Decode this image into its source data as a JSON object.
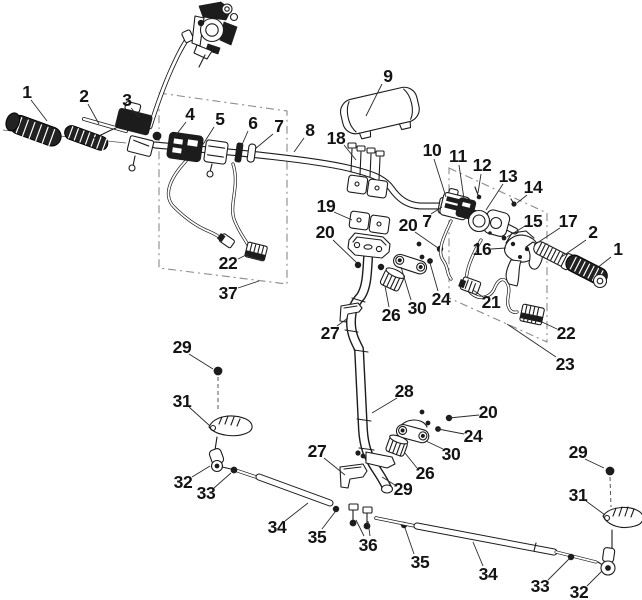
{
  "colors": {
    "ink": "#1c1c1c",
    "box_dash": "#8a8a8a",
    "leader": "#2b2b2b",
    "label": "#141414",
    "background": "#ffffff"
  },
  "callouts": [
    {
      "t": "1",
      "x": 27,
      "y": 92,
      "l": [
        31,
        100,
        47,
        121
      ]
    },
    {
      "t": "2",
      "x": 84,
      "y": 96,
      "l": [
        88,
        104,
        99,
        124
      ]
    },
    {
      "t": "3",
      "x": 127,
      "y": 100,
      "l": [
        131,
        108,
        139,
        117
      ]
    },
    {
      "t": "4",
      "x": 190,
      "y": 114,
      "l": [
        186,
        122,
        173,
        139
      ]
    },
    {
      "t": "5",
      "x": 220,
      "y": 119,
      "l": [
        214,
        127,
        202,
        146
      ]
    },
    {
      "t": "6",
      "x": 253,
      "y": 123,
      "l": [
        248,
        131,
        241,
        147
      ]
    },
    {
      "t": "7",
      "x": 279,
      "y": 126,
      "l": [
        273,
        134,
        255,
        149
      ]
    },
    {
      "t": "8",
      "x": 310,
      "y": 130,
      "l": [
        304,
        138,
        294,
        152
      ]
    },
    {
      "t": "9",
      "x": 388,
      "y": 76,
      "l": [
        382,
        84,
        366,
        116
      ]
    },
    {
      "t": "18",
      "x": 336,
      "y": 138,
      "l": [
        344,
        145,
        356,
        160
      ]
    },
    {
      "t": "10",
      "x": 432,
      "y": 150,
      "l": [
        434,
        159,
        446,
        197
      ]
    },
    {
      "t": "11",
      "x": 458,
      "y": 156,
      "l": [
        459,
        165,
        464,
        199
      ]
    },
    {
      "t": "12",
      "x": 482,
      "y": 165,
      "l": [
        481,
        174,
        478,
        193
      ]
    },
    {
      "t": "13",
      "x": 508,
      "y": 176,
      "l": [
        503,
        184,
        486,
        210
      ]
    },
    {
      "t": "14",
      "x": 533,
      "y": 187,
      "l": [
        527,
        195,
        517,
        203
      ]
    },
    {
      "t": "15",
      "x": 533,
      "y": 221,
      "l": [
        525,
        226,
        507,
        237
      ]
    },
    {
      "t": "17",
      "x": 568,
      "y": 221,
      "l": [
        560,
        228,
        534,
        245
      ]
    },
    {
      "t": "2",
      "x": 593,
      "y": 232,
      "l": [
        586,
        240,
        560,
        258
      ]
    },
    {
      "t": "1",
      "x": 618,
      "y": 249,
      "l": [
        611,
        257,
        592,
        272
      ]
    },
    {
      "t": "16",
      "x": 482,
      "y": 249,
      "l": [
        491,
        249,
        506,
        248
      ]
    },
    {
      "t": "19",
      "x": 326,
      "y": 206,
      "l": [
        334,
        212,
        352,
        220
      ]
    },
    {
      "t": "20",
      "x": 325,
      "y": 232,
      "l": [
        333,
        240,
        357,
        263
      ]
    },
    {
      "t": "20",
      "x": 408,
      "y": 225,
      "l": [
        415,
        232,
        438,
        248
      ]
    },
    {
      "t": "7",
      "x": 427,
      "y": 221,
      "l": [
        431,
        214,
        442,
        207
      ]
    },
    {
      "t": "24",
      "x": 441,
      "y": 299,
      "l": [
        438,
        291,
        430,
        263
      ]
    },
    {
      "t": "30",
      "x": 417,
      "y": 308,
      "l": [
        411,
        300,
        401,
        267
      ]
    },
    {
      "t": "26",
      "x": 391,
      "y": 315,
      "l": [
        389,
        307,
        385,
        286
      ]
    },
    {
      "t": "27",
      "x": 330,
      "y": 333,
      "l": [
        337,
        326,
        348,
        318
      ]
    },
    {
      "t": "21",
      "x": 491,
      "y": 302,
      "l": [
        483,
        297,
        473,
        290
      ]
    },
    {
      "t": "22",
      "x": 566,
      "y": 333,
      "l": [
        557,
        329,
        542,
        322
      ]
    },
    {
      "t": "23",
      "x": 565,
      "y": 364,
      "l": [
        556,
        357,
        507,
        324
      ]
    },
    {
      "t": "22",
      "x": 228,
      "y": 263,
      "l": [
        238,
        259,
        248,
        254
      ]
    },
    {
      "t": "37",
      "x": 228,
      "y": 293,
      "l": [
        238,
        288,
        259,
        281
      ]
    },
    {
      "t": "29",
      "x": 182,
      "y": 347,
      "l": [
        189,
        354,
        213,
        369
      ]
    },
    {
      "t": "31",
      "x": 182,
      "y": 401,
      "l": [
        189,
        407,
        210,
        426
      ]
    },
    {
      "t": "32",
      "x": 183,
      "y": 482,
      "l": [
        192,
        477,
        210,
        466
      ]
    },
    {
      "t": "33",
      "x": 206,
      "y": 493,
      "l": [
        214,
        488,
        231,
        473
      ]
    },
    {
      "t": "34",
      "x": 277,
      "y": 527,
      "l": [
        285,
        521,
        308,
        503
      ]
    },
    {
      "t": "35",
      "x": 317,
      "y": 537,
      "l": [
        322,
        529,
        335,
        512
      ]
    },
    {
      "t": "36",
      "x": 368,
      "y": 545,
      "l": [
        370,
        536,
        368,
        521
      ]
    },
    {
      "t": "35",
      "x": 420,
      "y": 562,
      "l": [
        414,
        554,
        405,
        528
      ]
    },
    {
      "t": "34",
      "x": 488,
      "y": 574,
      "l": [
        483,
        566,
        473,
        542
      ]
    },
    {
      "t": "33",
      "x": 540,
      "y": 586,
      "l": [
        548,
        580,
        569,
        559
      ]
    },
    {
      "t": "32",
      "x": 579,
      "y": 592,
      "l": [
        587,
        586,
        602,
        571
      ]
    },
    {
      "t": "29",
      "x": 578,
      "y": 452,
      "l": [
        585,
        459,
        604,
        468
      ]
    },
    {
      "t": "31",
      "x": 578,
      "y": 495,
      "l": [
        586,
        501,
        605,
        515
      ]
    },
    {
      "t": "28",
      "x": 404,
      "y": 391,
      "l": [
        397,
        398,
        372,
        413
      ]
    },
    {
      "t": "20",
      "x": 488,
      "y": 412,
      "l": [
        479,
        415,
        449,
        418
      ]
    },
    {
      "t": "24",
      "x": 473,
      "y": 436,
      "l": [
        464,
        434,
        438,
        429
      ]
    },
    {
      "t": "30",
      "x": 451,
      "y": 454,
      "l": [
        443,
        449,
        426,
        441
      ]
    },
    {
      "t": "26",
      "x": 425,
      "y": 473,
      "l": [
        417,
        468,
        405,
        453
      ]
    },
    {
      "t": "29",
      "x": 403,
      "y": 489,
      "l": [
        395,
        485,
        382,
        477
      ]
    },
    {
      "t": "27",
      "x": 317,
      "y": 451,
      "l": [
        324,
        458,
        345,
        475
      ]
    }
  ],
  "extra_leaders": [
    [
      364,
      536,
      356,
      520
    ]
  ]
}
